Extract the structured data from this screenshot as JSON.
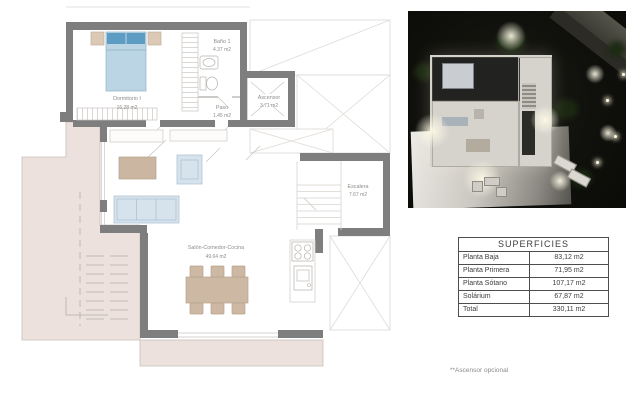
{
  "plan": {
    "rooms": {
      "dormitorio": {
        "name": "Dormitorio I",
        "area": "16.28 m2"
      },
      "bano": {
        "name": "Baño 1",
        "area": "4.37 m2"
      },
      "paso": {
        "name": "Paso",
        "area": "1.45 m2"
      },
      "ascensor": {
        "name": "Ascensor",
        "area": "3.71 m2"
      },
      "escalera": {
        "name": "Escalera",
        "area": "7.67 m2"
      },
      "salon": {
        "name": "Salón-Comedor-Cocina",
        "area": "49.64 m2"
      }
    }
  },
  "table": {
    "title": "SUPERFICIES",
    "rows": [
      {
        "label": "Planta Baja",
        "value": "83,12 m2"
      },
      {
        "label": "Planta Primera",
        "value": "71,95 m2"
      },
      {
        "label": "Planta Sótano",
        "value": "107,17 m2"
      },
      {
        "label": "Solárium",
        "value": "67,87 m2"
      },
      {
        "label": "Total",
        "value": "330,11 m2"
      }
    ]
  },
  "footnote": "**Ascensor opcional",
  "colors": {
    "wall": "#7e7e7e",
    "terrace": "#ece1dd",
    "bed_blue": "#5e9dc3",
    "sofa_blue": "#d6e3ed",
    "wood_tan": "#cdb9a3",
    "table_border": "#4d4d4d",
    "render_bg": "#0d0d0a"
  }
}
